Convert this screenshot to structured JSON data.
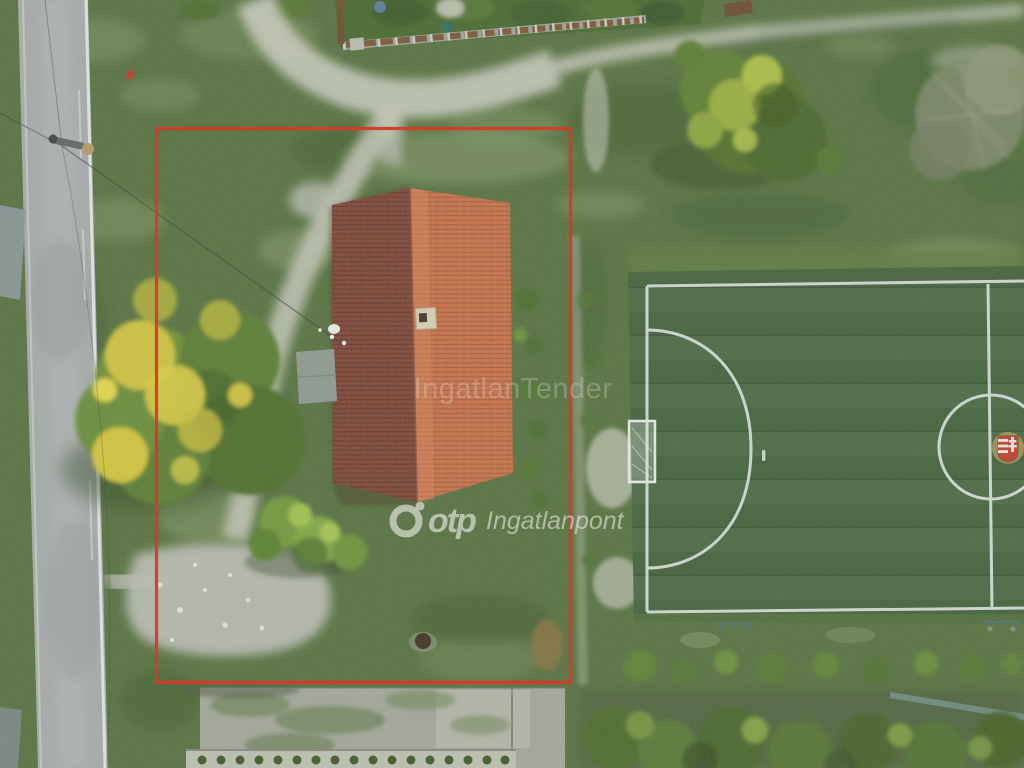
{
  "photo": {
    "description": "Aerial drone photograph of a rural plot: house with two-tone red tiled gable roof outlined by a red property-boundary rectangle, asphalt road on the left, dirt paths, large yellow-green tree, and an artificial-turf football pitch with white markings on the right.",
    "overlays": {
      "watermark_center": "IngatlanTender",
      "watermark_brand_bold": "otp",
      "watermark_brand_rest": "Ingatlanpont"
    },
    "colors": {
      "boundary_red": "#d63a28",
      "roof_west": "#7f4437",
      "roof_east": "#c86e47",
      "field_turf": "#41603a",
      "field_line": "#d9e3df",
      "grass_base": "#55703f",
      "road_asphalt": "#a6abac",
      "path_dirt": "#c8cabd",
      "gravel": "#b4b7ab",
      "tree_yellow": "#d9cc41",
      "watermark": "rgba(255,255,255,0.55)",
      "watermark_faint": "rgba(232,234,230,0.28)"
    },
    "scene_elements": [
      "asphalt-road-left",
      "road-edge-lines",
      "utility-pole",
      "power-lines",
      "dirt-path-network",
      "gravel-driveway",
      "wooden-fence-top",
      "garden-strip-top",
      "house-gable-roof",
      "chimney",
      "gray-shed",
      "satellite-dish",
      "yellow-flowering-tree",
      "bush-cluster",
      "top-right-tree",
      "dry-tree",
      "football-pitch",
      "goal-line",
      "touchlines",
      "halfway-line",
      "center-circle",
      "penalty-arc",
      "penalty-spot",
      "goal-frame",
      "center-crest",
      "blue-benches",
      "bush-row-south",
      "tree-row-bottom",
      "teal-fence",
      "weedy-concrete-yard",
      "garden-bed-row",
      "red-property-boundary",
      "watermarks"
    ]
  }
}
